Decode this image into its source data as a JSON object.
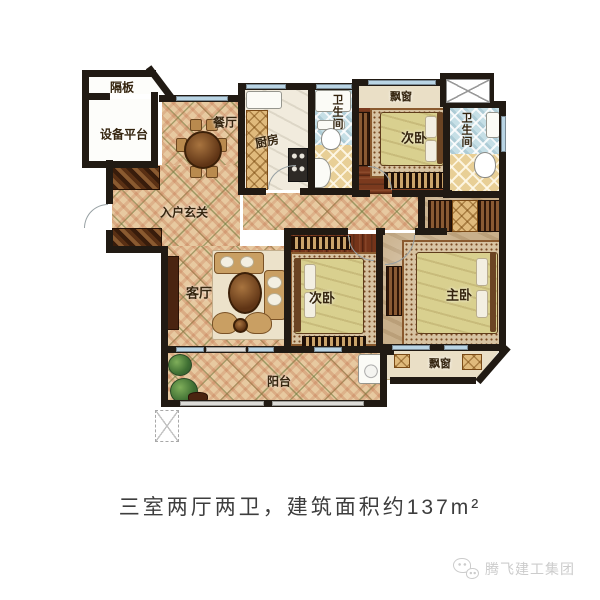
{
  "palette": {
    "wall": "#211a13",
    "window_glass": "#b9d4e4",
    "floor_tile": "#e7c9a0",
    "wood_floor": "#7b3a1e",
    "master_floor": "#c9b08b",
    "bath_tile": "#c6dfe6",
    "label_text": "#35250f",
    "caption_text": "#3d3d3d",
    "watermark_gray": "#cccccc"
  },
  "floorplan": {
    "rooms": [
      {
        "label": "隔板"
      },
      {
        "label": "设备平台"
      },
      {
        "label": "餐厅"
      },
      {
        "label": "厨房"
      },
      {
        "label": "卫生间"
      },
      {
        "label": "飘窗"
      },
      {
        "label": "次卧"
      },
      {
        "label": "卫生间"
      },
      {
        "label": "入户玄关"
      },
      {
        "label": "客厅"
      },
      {
        "label": "次卧"
      },
      {
        "label": "主卧"
      },
      {
        "label": "阳台"
      },
      {
        "label": "飘窗"
      }
    ]
  },
  "caption": {
    "text": "三室两厅两卫，建筑面积约137m²"
  },
  "watermark": {
    "brand": "腾飞建工集团",
    "icon": "wechat-icon"
  }
}
